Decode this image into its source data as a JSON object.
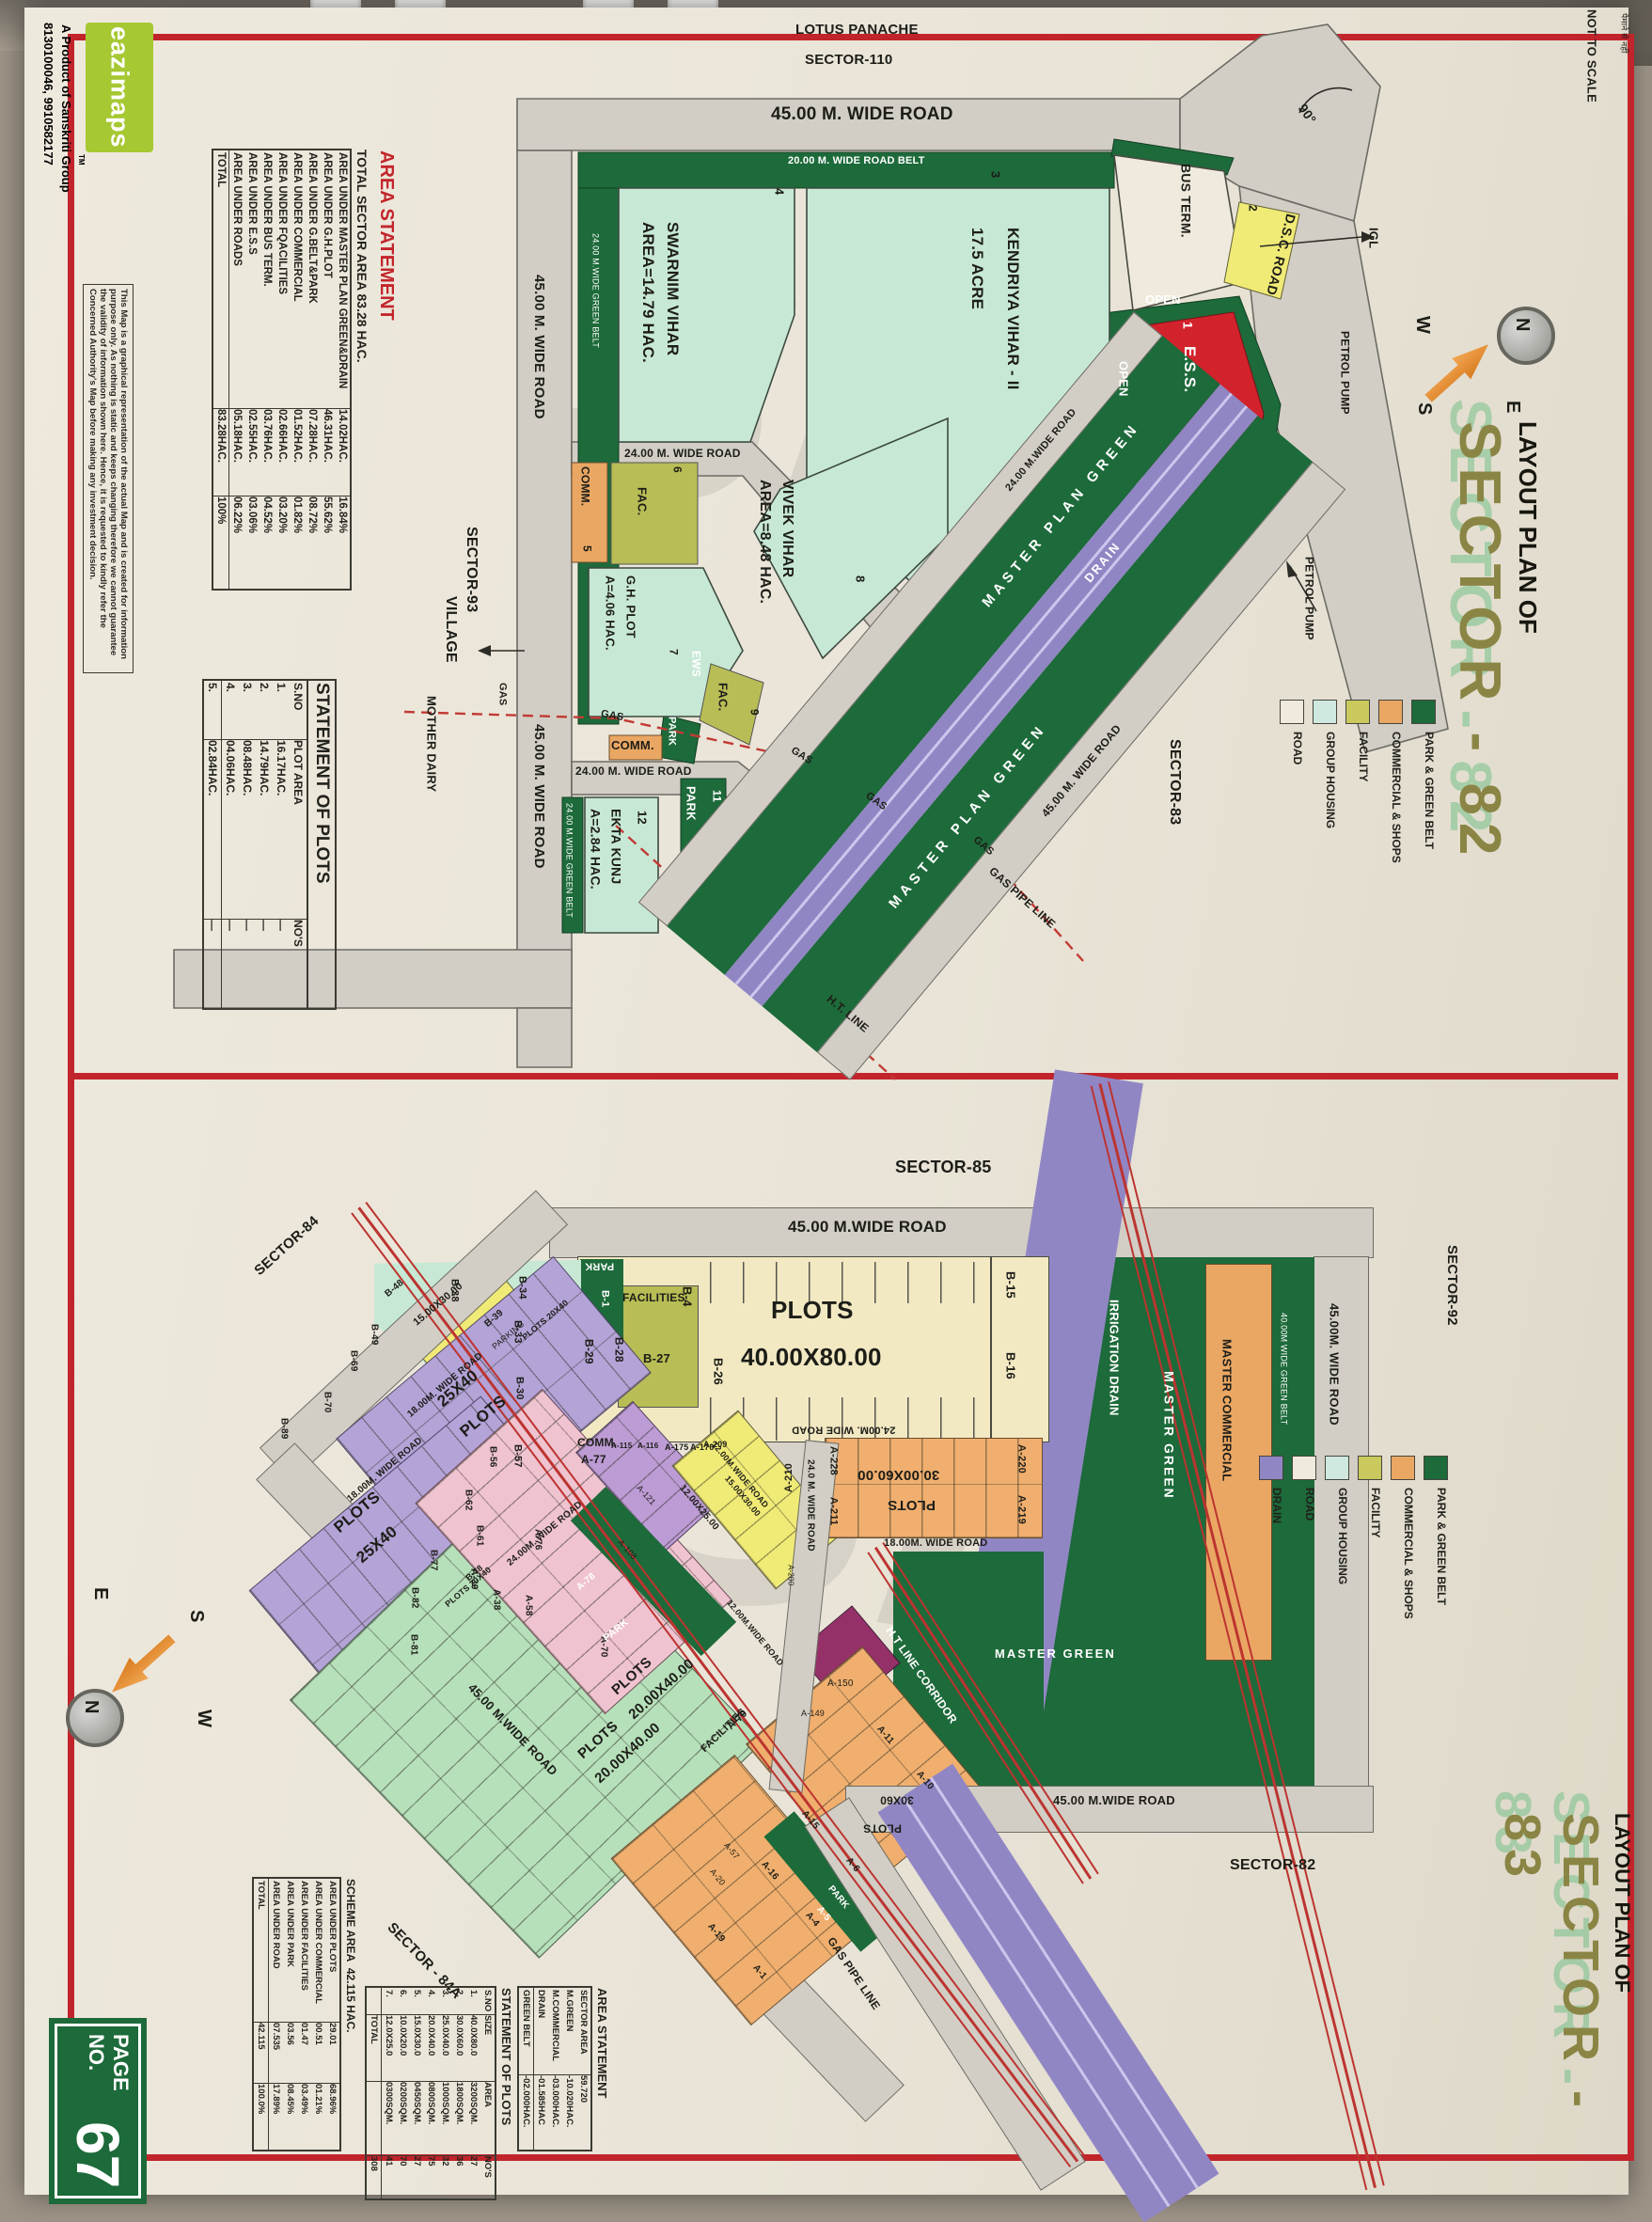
{
  "page": {
    "not_to_scale": "NOT TO SCALE",
    "scale_note_hi": "पैमाने से नहीं",
    "page_no_label": "PAGE NO.",
    "page_no": "67",
    "watermark": "Sk",
    "compass": {
      "n": "N",
      "e": "E",
      "s": "S",
      "w": "W"
    }
  },
  "brand": {
    "logo_text": "eazimaps",
    "tm": "TM",
    "tagline": "A Product of Sanskriti Group",
    "phone": "8130100046, 9910582177",
    "disclaimer": "This Map is a graphical representation of the actual Map and is created for information purpose only. As nothing is static and keeps changing therefore we cannot guarantee the validity of information shown here. Hence, it is requested to kindly refer the Concerned Authority's Map before making any investment decision."
  },
  "sector82": {
    "title1": "LAYOUT PLAN OF",
    "title2": "SECTOR - 82",
    "legend": {
      "items": [
        {
          "label": "PARK & GREEN BELT",
          "color": "#1d6a3a"
        },
        {
          "label": "COMMERCIAL & SHOPS",
          "color": "#eaa763"
        },
        {
          "label": "FACILITY",
          "color": "#c9c95e"
        },
        {
          "label": "GROUP HOUSING",
          "color": "#cfe9e0"
        },
        {
          "label": "ROAD",
          "color": "#efeadd"
        }
      ]
    },
    "area_statement": {
      "title": "AREA STATEMENT",
      "subtitle": "TOTAL SECTOR AREA 83.28 HAC.",
      "rows": [
        [
          "AREA UNDER MASTER PLAN GREEN&DRAIN",
          "14.02HAC.",
          "16.84%"
        ],
        [
          "AREA UNDER G.H.PLOT",
          "46.31HAC.",
          "55.62%"
        ],
        [
          "AREA UNDER G.BELT&PARK",
          "07.28HAC.",
          "08.72%"
        ],
        [
          "AREA UNDER COMMERCIAL",
          "01.52HAC.",
          "01.82%"
        ],
        [
          "AREA UNDER FQACILITIES",
          "02.66HAC.",
          "03.20%"
        ],
        [
          "AREA UNDER BUS TERM.",
          "03.76HAC.",
          "04.52%"
        ],
        [
          "AREA UNDER E.S.S",
          "02.55HAC.",
          "03.06%"
        ],
        [
          "AREA UNDER ROADS",
          "05.18HAC.",
          "06.22%"
        ],
        [
          "TOTAL",
          "83.28HAC.",
          "100%"
        ]
      ]
    },
    "plots_statement": {
      "title": "STATEMENT OF PLOTS",
      "headers": [
        "S.NO",
        "PLOT AREA",
        "NO'S"
      ],
      "rows": [
        [
          "1.",
          "16.17HAC.",
          "—"
        ],
        [
          "2.",
          "14.79HAC.",
          "—"
        ],
        [
          "3.",
          "08.48HAC.",
          "—"
        ],
        [
          "4.",
          "04.06HAC.",
          "—"
        ],
        [
          "5.",
          "02.84HAC.",
          "—"
        ]
      ]
    },
    "labels": {
      "lotus1": "LOTUS PANACHE",
      "lotus2": "SECTOR-110",
      "road45": "45.00 M. WIDE ROAD",
      "belt20": "20.00 M. WIDE ROAD BELT",
      "belt24": "24.00 M.WIDE GREEN BELT",
      "road24": "24.00 M. WIDE ROAD",
      "road24c": "24.00 M.WIDE ROAD",
      "mpg": "MASTER PLAN GREEN",
      "drain": "DRAIN",
      "sector93": "SECTOR-93",
      "village": "VILLAGE",
      "mother": "MOTHER DAIRY",
      "gas": "GAS",
      "gaspipe": "GAS PIPE LINE",
      "htline": "H.T. LINE",
      "sector83": "SECTOR-83",
      "dsc": "D.S.C. ROAD",
      "igl": "IGL",
      "petrol": "PETROL PUMP",
      "deg90": "90°",
      "busterm": "BUS TERM.",
      "open": "OPEN",
      "ess": "E.S.S.",
      "swarnim1": "SWARNIM VIHAR",
      "swarnim2": "AREA=14.79 HAC.",
      "kendriya1": "KENDRIYA VIHAR - II",
      "kendriya2": "17.5 ACRE",
      "vivek1": "VIVEK VIHAR",
      "vivek2": "AREA=8.48 HAC.",
      "gh1": "G.H. PLOT",
      "gh2": "A=4.06 HAC.",
      "ekta1": "EKTA KUNJ",
      "ekta2": "A=2.84 HAC.",
      "ews": "EWS",
      "fac": "FAC.",
      "comm": "COMM.",
      "park": "PARK",
      "n1": "1",
      "n2": "2",
      "n3": "3",
      "n4": "4",
      "n5": "5",
      "n6": "6",
      "n7": "7",
      "n8": "8",
      "n9": "9",
      "n11": "11",
      "n12": "12"
    }
  },
  "sector83": {
    "title1": "LAYOUT PLAN OF",
    "title2": "SECTOR - 83",
    "legend": {
      "items": [
        {
          "label": "PARK & GREEN BELT",
          "color": "#1d6a3a"
        },
        {
          "label": "COMMERCIAL & SHOPS",
          "color": "#eaa763"
        },
        {
          "label": "FACILITY",
          "color": "#c9c95e"
        },
        {
          "label": "GROUP HOUSING",
          "color": "#cfe9e0"
        },
        {
          "label": "ROAD",
          "color": "#efeadd"
        },
        {
          "label": "DRAIN",
          "color": "#9186c4"
        }
      ]
    },
    "area_statement": {
      "title": "AREA STATEMENT",
      "rows": [
        [
          "SECTOR AREA",
          "59.720"
        ],
        [
          "M.GREEN",
          "-10.020HAC."
        ],
        [
          "M.COMMERCIAL",
          "-03.000HAC."
        ],
        [
          "DRAIN",
          "-01.585HAC"
        ],
        [
          "GREEN BELT",
          "-02.000HAC."
        ]
      ]
    },
    "scheme": {
      "title_label": "SCHEME AREA",
      "title_value": "42.115 HAC.",
      "rows": [
        [
          "AREA UNDER PLOTS",
          "29.01",
          "68.96%"
        ],
        [
          "AREA UNDER COMMERCIAL",
          "00.51",
          "01.21%"
        ],
        [
          "AREA UNDER FACILITIES",
          "01.47",
          "03.49%"
        ],
        [
          "AREA UNDER PARK",
          "03.56",
          "08.45%"
        ],
        [
          "AREA UNDER ROAD",
          "07.535",
          "17.89%"
        ],
        [
          "TOTAL",
          "42.115",
          "100.0%"
        ]
      ]
    },
    "plots_statement": {
      "title": "STATEMENT OF PLOTS",
      "headers": [
        "S.NO",
        "SIZE",
        "AREA",
        "NO'S"
      ],
      "rows": [
        [
          "1.",
          "40.0X80.0",
          "3200SQM.",
          "27"
        ],
        [
          "2.",
          "30.0X60.0",
          "1800SQM.",
          "36"
        ],
        [
          "3.",
          "25.0X40.0",
          "1000SQM.",
          "32"
        ],
        [
          "4.",
          "20.0X40.0",
          "0800SQM.",
          "75"
        ],
        [
          "5.",
          "15.0X30.0",
          "0450SQM.",
          "27"
        ],
        [
          "6.",
          "10.0X20.0",
          "0200SQM.",
          "70"
        ],
        [
          "7.",
          "12.0X25.0",
          "0300SQM.",
          "41"
        ],
        [
          "",
          "TOTAL",
          "",
          "308"
        ]
      ]
    },
    "labels": {
      "sector85": "SECTOR-85",
      "sector84": "SECTOR-84",
      "sector84a": "SECTOR - 84A",
      "sector92": "SECTOR-92",
      "sector82b": "SECTOR-82",
      "road45": "45.00 M.WIDE ROAD",
      "road45b": "45.00M. WIDE ROAD",
      "road24": "24.00M. WIDE ROAD",
      "road24b": "24.0 M. WIDE ROAD",
      "road18": "18.00M. WIDE ROAD",
      "road12": "12.00M.WIDE ROAD",
      "greenbelt40": "40.00M WIDE GREEN BELT",
      "mcommercial": "MASTER COMMERCIAL",
      "mgreen": "MASTER GREEN",
      "irrigation": "IRRIGATION DRAIN",
      "htcorr": "H.T LINE CORRIDOR",
      "gaspipe": "GAS PIPE LINE",
      "plots_word": "PLOTS",
      "size4080": "40.00X80.00",
      "size3060": "30.00X60.00",
      "size3060s": "30X60",
      "size2540": "25X40",
      "size2040": "20.00X40.00",
      "plots2040s": "PLOTS 20X40",
      "size1530": "15.00X30.00",
      "size1225": "12.00X25.00",
      "facilities": "FACILITIES",
      "parking": "PARKING",
      "park": "PARK",
      "comm": "COMM."
    },
    "codes": {
      "b1": "B-1",
      "b4": "B-4",
      "b15": "B-15",
      "b16": "B-16",
      "b26": "B-26",
      "b27": "B-27",
      "b28": "B-28",
      "b29": "B-29",
      "b30": "B-30",
      "b33": "B-33",
      "b34": "B-34",
      "b38": "B-38",
      "b39": "B-39",
      "b48": "B-48",
      "b49": "B-49",
      "b56": "B-56",
      "b57": "B-57",
      "b61": "B-61",
      "b62": "B-62",
      "b69": "B-69",
      "b70": "B-70",
      "b77": "B-77",
      "b78": "B-78",
      "b81": "B-81",
      "b82": "B-82",
      "b89": "B-89",
      "a1": "A-1",
      "a4": "A-4",
      "a5": "A-5",
      "a6": "A-6",
      "a10": "A-10",
      "a11": "A-11",
      "a15": "A-15",
      "a16": "A-16",
      "a19": "A-19",
      "a20": "A-20",
      "a38": "A-38",
      "a39": "A-39",
      "a57": "A-57",
      "a58": "A-58",
      "a70": "A-70",
      "a76": "A-76",
      "a77": "A-77",
      "a78": "A-78",
      "a79": "A-79",
      "a108": "A-108",
      "a115": "A-115",
      "a116": "A-116",
      "a121": "A-121",
      "a149": "A-149",
      "a150": "A-150",
      "a175": "A-175",
      "a176": "A-176",
      "a200": "A-200",
      "a209": "A-209",
      "a210": "A-210",
      "a211": "A-211",
      "a219": "A-219",
      "a220": "A-220",
      "a228": "A-228"
    }
  }
}
